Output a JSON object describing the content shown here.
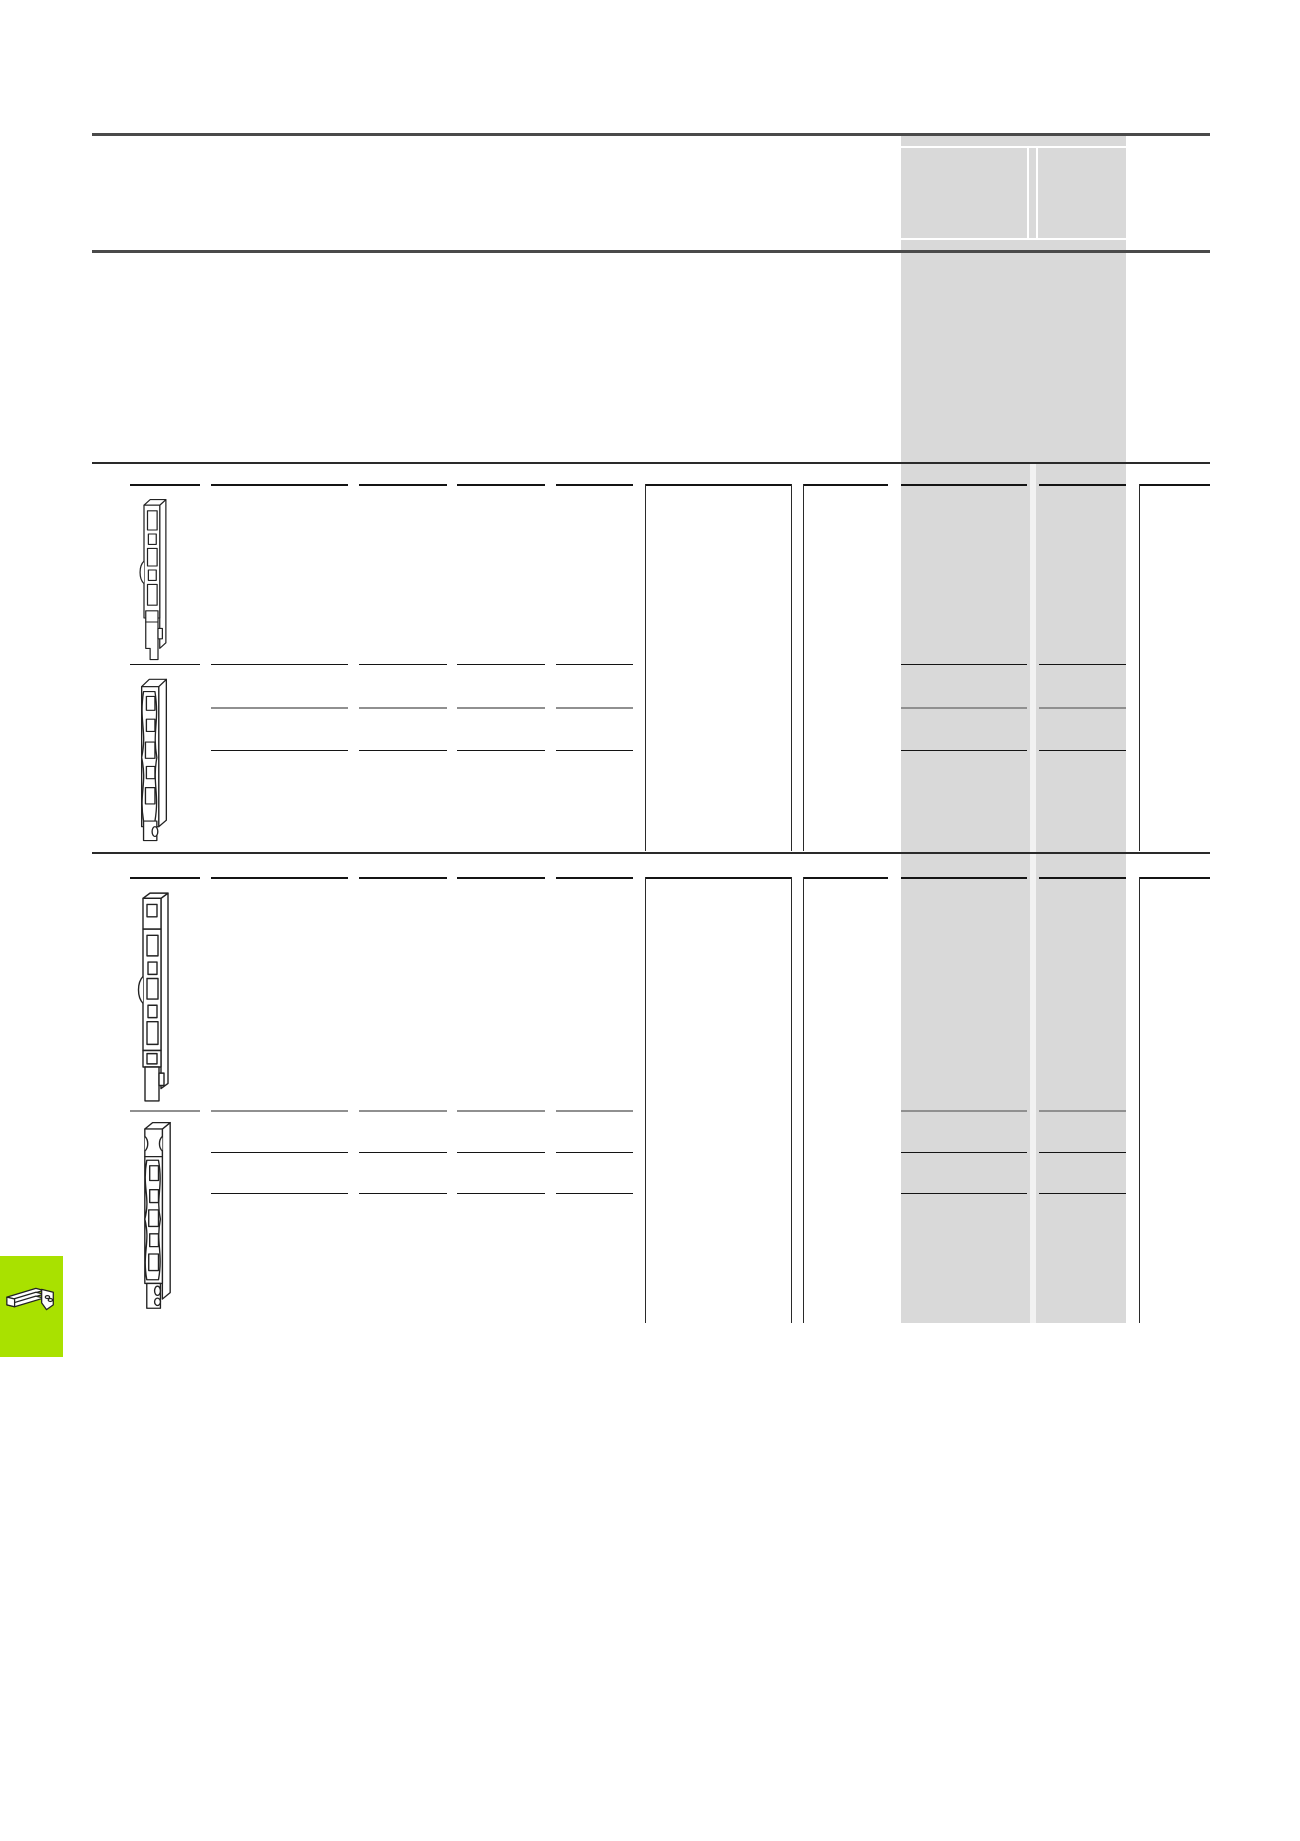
{
  "page": {
    "width": 1300,
    "height": 1841,
    "background": "#ffffff"
  },
  "colors": {
    "heavy_rule": "#4a4a4a",
    "section_rule": "#2a2a2a",
    "black_row_line": "#141414",
    "gray_row_line": "#909090",
    "vertical_line": "#2a2a2a",
    "band_fill": "#d9d9d9",
    "band_divider_fill": "#f2f2f2",
    "tab_green": "#a9e100",
    "line_art_stroke": "#222222"
  },
  "heavy_rules": [
    {
      "y": 133,
      "x1": 92,
      "x2": 1210,
      "h": 3
    },
    {
      "y": 250,
      "x1": 92,
      "x2": 1210,
      "h": 3
    }
  ],
  "band": {
    "x": 901,
    "width": 225,
    "top": 136,
    "bottom": 1323,
    "header": {
      "white_h_lines": [
        146,
        238
      ],
      "white_v_lines": [
        1027,
        1036
      ],
      "cell_top": 146,
      "cell_bottom": 238
    },
    "column_divider": {
      "x": 1030,
      "width": 6,
      "from": 463,
      "to": 1323
    }
  },
  "grid": {
    "frame": {
      "left": 92,
      "right": 1210
    },
    "columns": {
      "c1": [
        130,
        200
      ],
      "c2": [
        211,
        348
      ],
      "c3": [
        359,
        447
      ],
      "c4": [
        457,
        545
      ],
      "c5": [
        556,
        633
      ],
      "c6": [
        645,
        791
      ],
      "c7": [
        803,
        888
      ],
      "g1": [
        901,
        1027
      ],
      "g2": [
        1039,
        1126
      ],
      "rc": [
        1139,
        1210
      ]
    },
    "sections": [
      {
        "top_rule": 462,
        "header_y": 484,
        "header_cols": [
          "c1",
          "c2",
          "c3",
          "c4",
          "c5",
          "c6",
          "c7",
          "g1",
          "g2",
          "rc"
        ],
        "rows": [
          {
            "y": 664,
            "style": "black",
            "cols": [
              "c1",
              "c2",
              "c3",
              "c4",
              "c5",
              "g1",
              "g2"
            ]
          },
          {
            "y": 707,
            "style": "gray",
            "cols": [
              "c2",
              "c3",
              "c4",
              "c5",
              "g1",
              "g2"
            ]
          },
          {
            "y": 750,
            "style": "black",
            "cols": [
              "c2",
              "c3",
              "c4",
              "c5",
              "g1",
              "g2"
            ]
          }
        ],
        "verticals": {
          "x": [
            645,
            791,
            803,
            1139
          ],
          "from": 484,
          "to": 851
        },
        "bottom_rule": 852
      },
      {
        "top_rule": null,
        "header_y": 877,
        "header_cols": [
          "c1",
          "c2",
          "c3",
          "c4",
          "c5",
          "c6",
          "c7",
          "g1",
          "g2",
          "rc"
        ],
        "rows": [
          {
            "y": 1110,
            "style": "gray",
            "cols": [
              "c1",
              "c2",
              "c3",
              "c4",
              "c5",
              "g1",
              "g2"
            ]
          },
          {
            "y": 1152,
            "style": "black",
            "cols": [
              "c2",
              "c3",
              "c4",
              "c5",
              "g1",
              "g2"
            ]
          },
          {
            "y": 1193,
            "style": "black",
            "cols": [
              "c2",
              "c3",
              "c4",
              "c5",
              "g1",
              "g2"
            ]
          }
        ],
        "verticals": {
          "x": [
            645,
            791,
            803,
            1139
          ],
          "from": 877,
          "to": 1323
        },
        "bottom_rule": null
      }
    ]
  },
  "images": [
    {
      "name": "fuse-switch-strip-1",
      "variant": "A",
      "x": 137,
      "y": 494,
      "w": 35,
      "h": 168
    },
    {
      "name": "fuse-switch-strip-2",
      "variant": "B",
      "x": 135,
      "y": 672,
      "w": 38,
      "h": 171
    },
    {
      "name": "fuse-switch-strip-3",
      "variant": "A",
      "x": 135,
      "y": 888,
      "w": 40,
      "h": 216
    },
    {
      "name": "fuse-switch-strip-4",
      "variant": "B",
      "x": 138,
      "y": 1118,
      "w": 39,
      "h": 193
    }
  ],
  "corner_tab": {
    "x": 0,
    "y": 1256,
    "w": 63,
    "h": 101,
    "icon": "busbar-adapter-icon"
  }
}
